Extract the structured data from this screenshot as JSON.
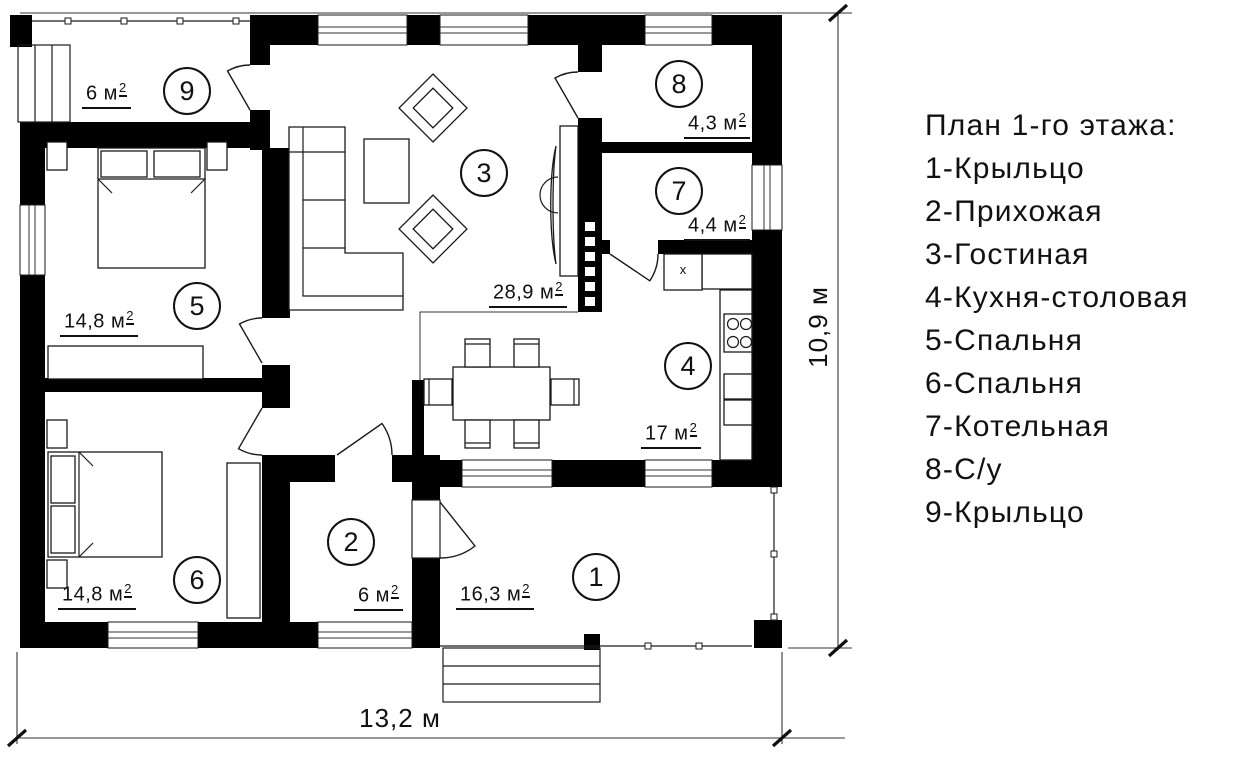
{
  "legend": {
    "title": "План 1-го этажа:",
    "items": [
      "1-Крыльцо",
      "2-Прихожая",
      "3-Гостиная",
      "4-Кухня-столовая",
      "5-Спальня",
      "6-Спальня",
      "7-Котельная",
      "8-С/у",
      "9-Крыльцо"
    ]
  },
  "plan": {
    "rooms": [
      {
        "number": "1",
        "area": "16,3 м",
        "area_sup": "2"
      },
      {
        "number": "2",
        "area": "6 м",
        "area_sup": "2"
      },
      {
        "number": "3",
        "area": "28,9 м",
        "area_sup": "2"
      },
      {
        "number": "4",
        "area": "17 м",
        "area_sup": "2"
      },
      {
        "number": "5",
        "area": "14,8 м",
        "area_sup": "2"
      },
      {
        "number": "6",
        "area": "14,8 м",
        "area_sup": "2"
      },
      {
        "number": "7",
        "area": "4,4 м",
        "area_sup": "2"
      },
      {
        "number": "8",
        "area": "4,3 м",
        "area_sup": "2"
      },
      {
        "number": "9",
        "area": "6 м",
        "area_sup": "2"
      }
    ],
    "appliance_label": "x",
    "dimensions": {
      "width": "13,2 м",
      "height": "10,9 м"
    }
  }
}
